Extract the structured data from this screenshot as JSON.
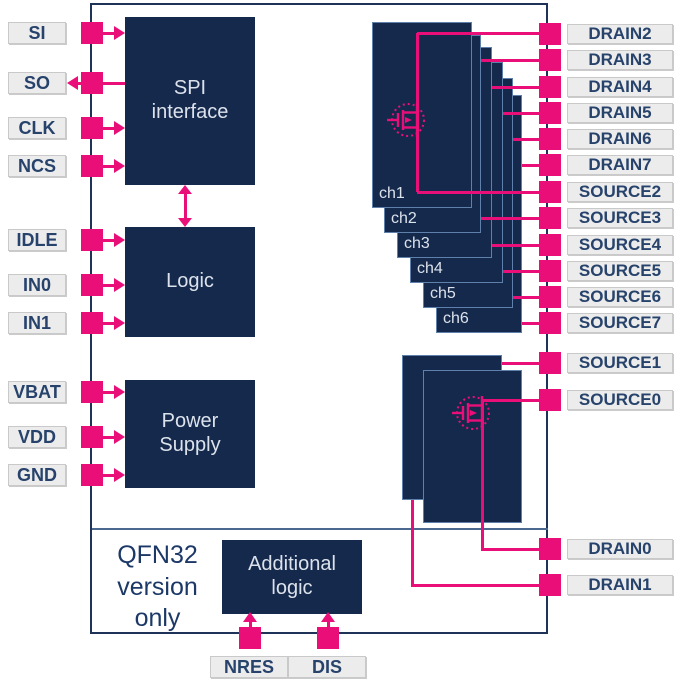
{
  "colors": {
    "accent_pink": "#EA0E78",
    "block_navy": "#15294D",
    "outline_navy": "#1E3357",
    "pin_label_bg": "#ECECEC",
    "pin_label_text": "#27436C",
    "block_text": "#DCE2EB"
  },
  "blocks": {
    "spi_interface": "SPI\ninterface",
    "logic": "Logic",
    "power_supply": "Power\nSupply",
    "additional_logic": "Additional\nlogic"
  },
  "note_qfn32": "QFN32\nversion\nonly",
  "left_pins": [
    {
      "label": "SI",
      "direction": "in"
    },
    {
      "label": "SO",
      "direction": "out"
    },
    {
      "label": "CLK",
      "direction": "in"
    },
    {
      "label": "NCS",
      "direction": "in"
    },
    {
      "label": "IDLE",
      "direction": "in"
    },
    {
      "label": "IN0",
      "direction": "in"
    },
    {
      "label": "IN1",
      "direction": "in"
    },
    {
      "label": "VBAT",
      "direction": "in"
    },
    {
      "label": "VDD",
      "direction": "in"
    },
    {
      "label": "GND",
      "direction": "in"
    }
  ],
  "right_pins": [
    {
      "label": "DRAIN2"
    },
    {
      "label": "DRAIN3"
    },
    {
      "label": "DRAIN4"
    },
    {
      "label": "DRAIN5"
    },
    {
      "label": "DRAIN6"
    },
    {
      "label": "DRAIN7"
    },
    {
      "label": "SOURCE2"
    },
    {
      "label": "SOURCE3"
    },
    {
      "label": "SOURCE4"
    },
    {
      "label": "SOURCE5"
    },
    {
      "label": "SOURCE6"
    },
    {
      "label": "SOURCE7"
    },
    {
      "label": "SOURCE1"
    },
    {
      "label": "SOURCE0"
    },
    {
      "label": "DRAIN0"
    },
    {
      "label": "DRAIN1"
    }
  ],
  "bottom_pins": [
    {
      "label": "NRES"
    },
    {
      "label": "DIS"
    }
  ],
  "channels": [
    {
      "label": "ch1"
    },
    {
      "label": "ch2"
    },
    {
      "label": "ch3"
    },
    {
      "label": "ch4"
    },
    {
      "label": "ch5"
    },
    {
      "label": "ch6"
    }
  ]
}
